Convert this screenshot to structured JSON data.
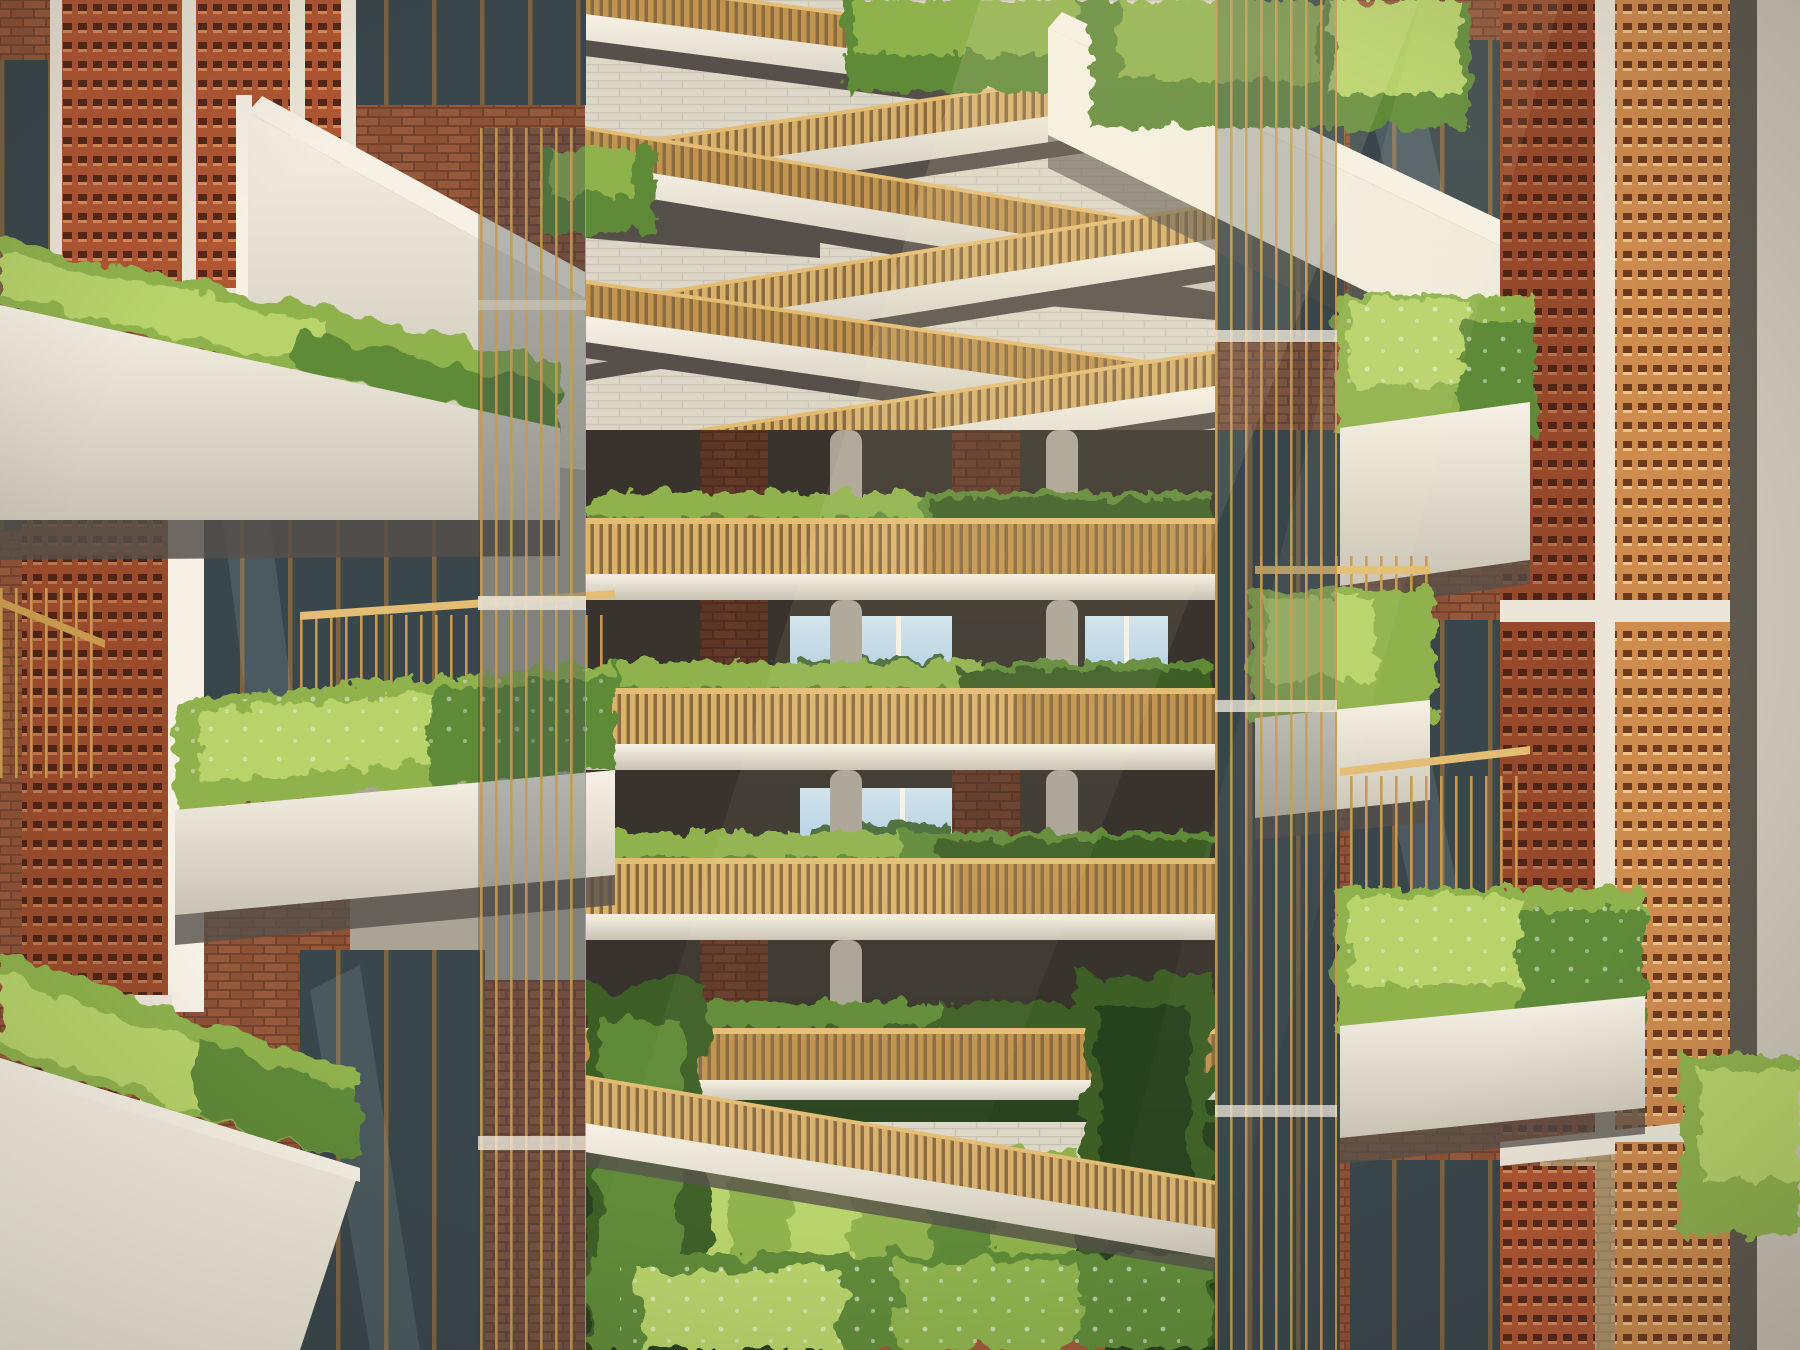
{
  "meta": {
    "alt": "Sunlit residential atrium rendering: stacked cream concrete balconies overflowing with ferns and flowering plants, terracotta brick lattice screens, brass-slatted zigzag walkways criss-crossing the void, glimpses of blue sky through far openings, and a lush garden courtyard at the base."
  },
  "palette": {
    "cream": "#ece6d8",
    "cream2": "#f6f1e4",
    "conc": "#c9c3b5",
    "conc2": "#aaa497",
    "grayc": "#8b8679",
    "shadow": "#55504a",
    "dark": "#38342d",
    "gold": "#c79a4f",
    "gold2": "#e4bd74",
    "gold3": "#8a6a40",
    "terr": "#b05633",
    "terr_dark": "#542718",
    "terr_lip": "#d98a58",
    "terr_gold": "#cf8c4f",
    "terr_hole_gold": "#6e3a1e",
    "terr_lip_gold": "#f0c488",
    "brick": "#8d5136",
    "brick2": "#97593c",
    "brick_mortar": "#74432e",
    "brick_tan": "#c3a67c",
    "brick_tan2": "#b1946a",
    "tan_mortar": "#a08a66",
    "block": "#ddd7c8",
    "block_line": "#c2bcac",
    "green1": "#b7d36a",
    "green2": "#8fb24d",
    "green3": "#5f8a38",
    "green4": "#3c5f28",
    "green5": "#28421d",
    "glass": "#39464b",
    "glass_hi": "#8fa4ab",
    "sky": "#aecde2",
    "sky2": "#cfe3ef",
    "floor_terra": "#9c5a38"
  }
}
